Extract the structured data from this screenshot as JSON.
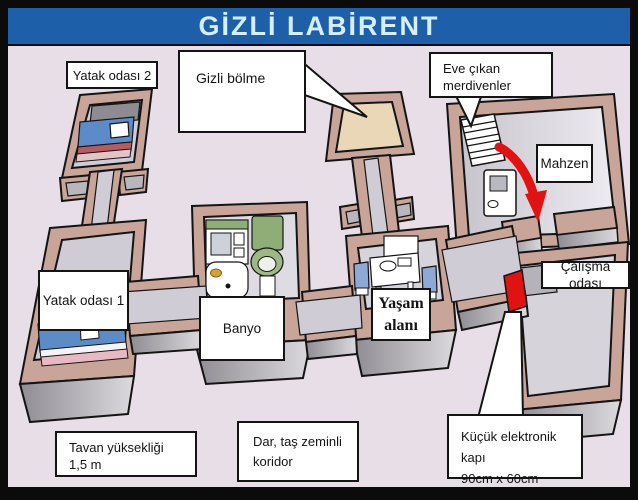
{
  "title": "GİZLİ LABİRENT",
  "colors": {
    "banner_blue": "#1d5fa9",
    "banner_text": "#d6effd",
    "background": "#e7dee8",
    "wall_tan": "#c9a499",
    "floor_gray": "#cfccd6",
    "secret_floor": "#e9d7b8",
    "accent_red": "#e11212"
  },
  "labels": {
    "bedroom2": "Yatak odası 2",
    "secret_compartment": "Gizli bölme",
    "stairs_note": {
      "line1": "Eve çıkan",
      "line2": "merdivenler"
    },
    "cellar": "Mahzen",
    "bedroom1": "Yatak odası 1",
    "bathroom": "Banyo",
    "living_area": {
      "line1": "Yaşam",
      "line2": "alanı"
    },
    "study": "Çalışma odası",
    "ceiling_note": {
      "line1": "Tavan yüksekliği",
      "line2": "1,5 m"
    },
    "corridor_note": {
      "line1": "Dar, taş zeminli",
      "line2": "koridor"
    },
    "door_note": {
      "line1": "Küçük elektronik kapı",
      "line2": "90cm x 60cm"
    }
  }
}
